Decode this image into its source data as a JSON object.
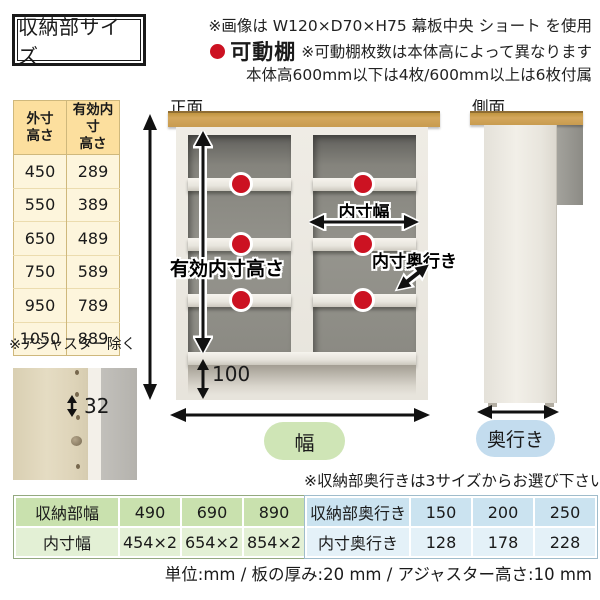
{
  "header": {
    "title": "収納部サイズ",
    "note_image": "※画像は W120×D70×H75 幕板中央 ショート を使用",
    "movable_shelf_label": "可動棚",
    "movable_shelf_note1": "※可動棚枚数は本体高によって異なります",
    "movable_shelf_note2": "本体高600mm以下は4枚/600mm以上は6枚付属"
  },
  "height_table": {
    "col_headers": [
      "外寸\n高さ",
      "有効内寸\n高さ"
    ],
    "rows": [
      [
        "450",
        "289"
      ],
      [
        "550",
        "389"
      ],
      [
        "650",
        "489"
      ],
      [
        "750",
        "589"
      ],
      [
        "950",
        "789"
      ],
      [
        "1050",
        "889"
      ]
    ],
    "note": "※アジャスター除く"
  },
  "shelf_pitch": {
    "value": "32"
  },
  "front_view": {
    "label": "正面",
    "inner_height_label": "有効内寸高さ",
    "inner_width_label": "内寸幅",
    "inner_depth_label": "内寸奥行き",
    "plinth_height": "100",
    "width_pill": "幅"
  },
  "side_view": {
    "label": "側面",
    "depth_pill": "奥行き"
  },
  "depth_note": "※収納部奥行きは3サイズからお選び下さい",
  "width_table": {
    "rows": [
      {
        "label": "収納部幅",
        "values": [
          "490",
          "690",
          "890"
        ]
      },
      {
        "label": "内寸幅",
        "values": [
          "454×2",
          "654×2",
          "854×2"
        ]
      }
    ]
  },
  "depth_table": {
    "rows": [
      {
        "label": "収納部奥行き",
        "values": [
          "150",
          "200",
          "250"
        ]
      },
      {
        "label": "内寸奥行き",
        "values": [
          "128",
          "178",
          "228"
        ]
      }
    ]
  },
  "footer": {
    "units_line": "単位:mm / 板の厚み:20 mm / アジャスター高さ:10 mm"
  },
  "colors": {
    "accent_red": "#cc1222",
    "wood_top": "#d4a75c",
    "pill_green": "#cfe5b6",
    "pill_blue": "#c3dcee",
    "height_table_header": "#fcdf9e",
    "height_table_cell": "#fdf5dc",
    "width_table_row1": "#c9e1ae",
    "width_table_row2": "#e3f0d5",
    "depth_table_row1": "#cbe3f0",
    "depth_table_row2": "#e4f1f8"
  }
}
